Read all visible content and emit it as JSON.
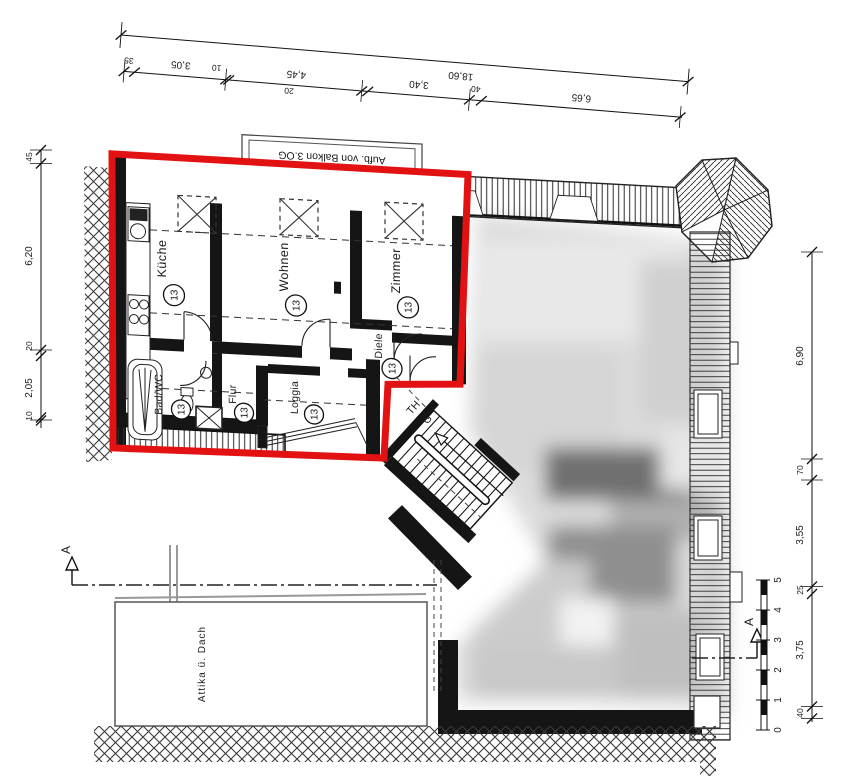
{
  "colors": {
    "highlight": "#e31212",
    "ink": "#1a1a1a",
    "paper": "#ffffff"
  },
  "annotation_box": {
    "text": "Aufb. von Balkon 3.OG"
  },
  "rooms": {
    "kueche": {
      "name": "Küche",
      "number": "13"
    },
    "wohnen": {
      "name": "Wohnen",
      "number": "13"
    },
    "zimmer": {
      "name": "Zimmer",
      "number": "13"
    },
    "diele": {
      "name": "Diele",
      "number": "13"
    },
    "bad": {
      "name": "Bad/WC",
      "number": "13"
    },
    "flur": {
      "name": "Flur",
      "number": "13"
    },
    "loggia": {
      "name": "Loggia",
      "number": "13"
    }
  },
  "stairwell": {
    "line1": "TH",
    "line2": "G"
  },
  "attika": {
    "label": "Attika ü. Dach"
  },
  "dimensions": {
    "top": {
      "total": "18,60",
      "seg35": "35",
      "seg305": "3,05",
      "seg10": "10",
      "seg445": "4,45",
      "seg20": "20",
      "seg340": "3,40",
      "seg40": "40",
      "seg665": "6,65"
    },
    "left": {
      "seg45": "45",
      "seg620": "6,20",
      "seg20": "20",
      "seg205": "2,05",
      "seg10": "10"
    },
    "right": {
      "seg690": "6,90",
      "seg70": "70",
      "seg355": "3,55",
      "seg25": "25",
      "seg375": "3,75",
      "seg40": "40"
    }
  },
  "section": {
    "label": "A"
  },
  "scale_bar": {
    "n0": "0",
    "n1": "1",
    "n2": "2",
    "n3": "3",
    "n4": "4",
    "n5": "5"
  }
}
